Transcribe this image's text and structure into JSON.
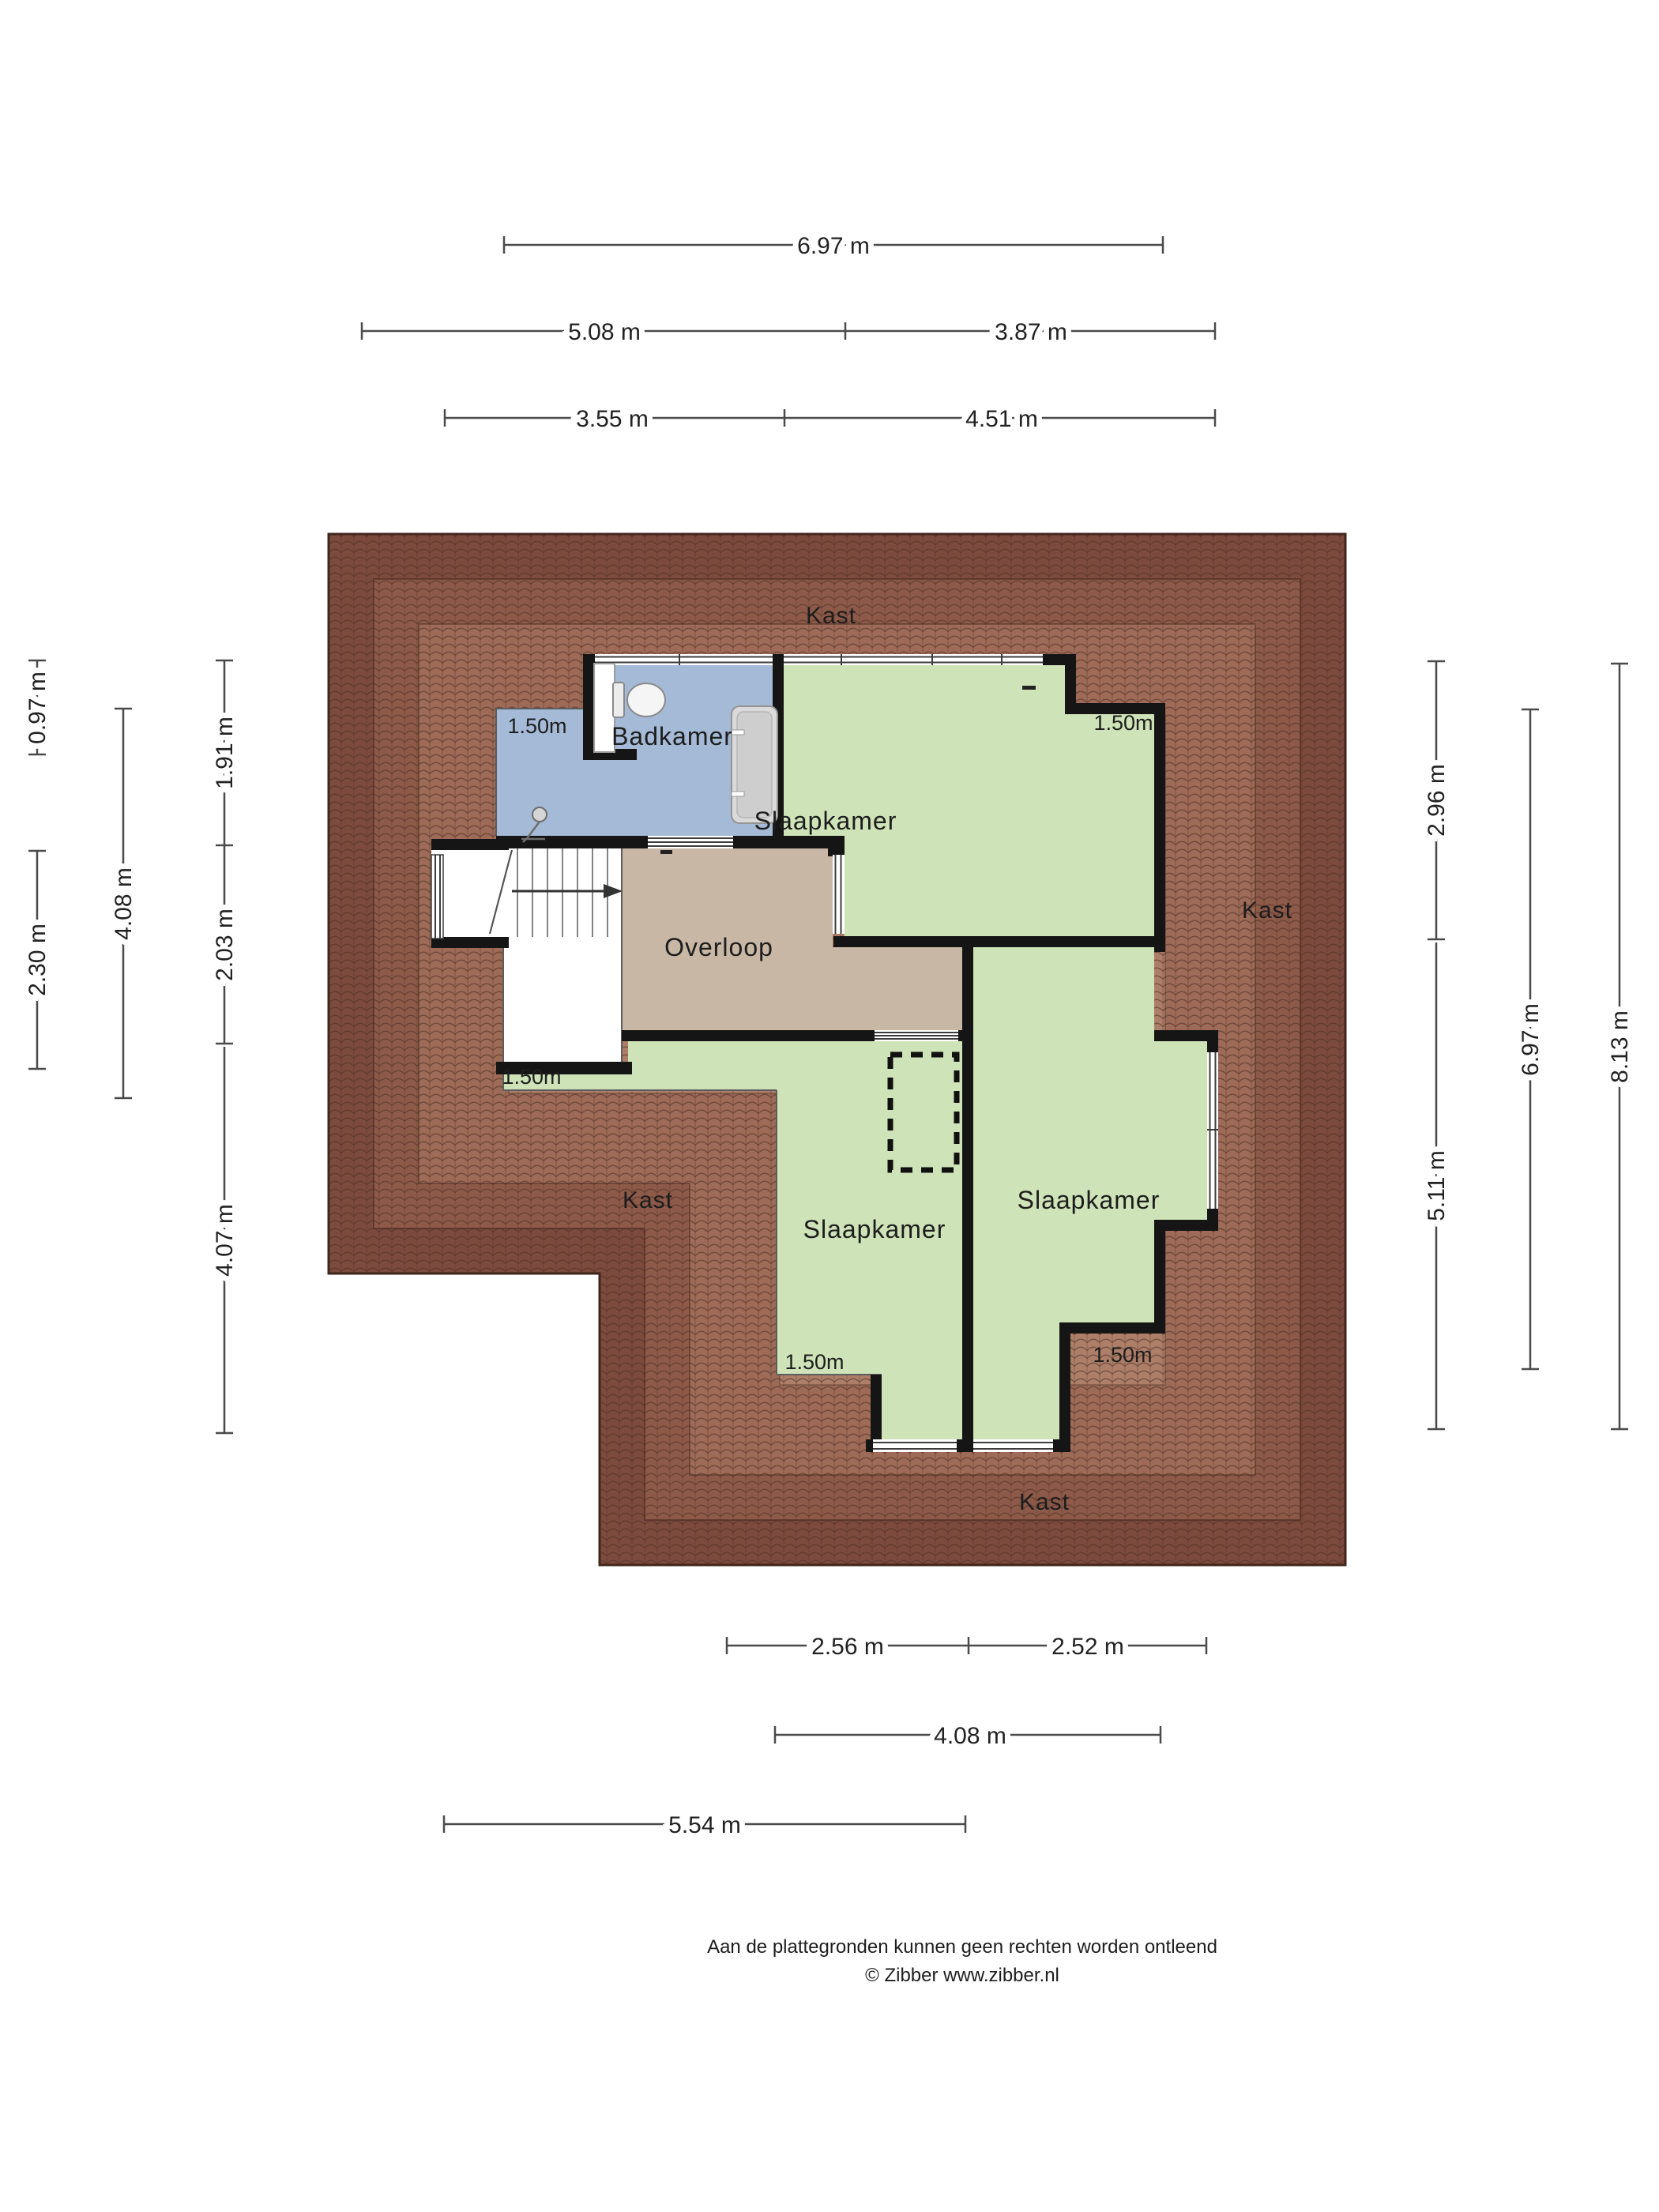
{
  "plan": {
    "rooms": [
      {
        "name": "Badkamer"
      },
      {
        "name": "Slaapkamer"
      },
      {
        "name": "Overloop"
      },
      {
        "name": "Slaapkamer"
      },
      {
        "name": "Slaapkamer"
      }
    ],
    "closets": [
      "Kast",
      "Kast",
      "Kast",
      "Kast"
    ],
    "clearance_labels": [
      "1.50m",
      "1.50m",
      "1.50m",
      "1.50m",
      "1.50m"
    ],
    "icons": [
      "toilet-icon",
      "bathtub-icon",
      "shower-icon",
      "stairs-arrow-icon"
    ]
  },
  "dimensions": {
    "top": [
      "6.97 m",
      "5.08 m",
      "3.87 m",
      "3.55 m",
      "4.51 m"
    ],
    "bottom": [
      "2.56 m",
      "2.52 m",
      "4.08 m",
      "5.54 m"
    ],
    "left": [
      "0.97 m",
      "2.30 m",
      "4.08 m",
      "1.91 m",
      "2.03 m",
      "4.07 m"
    ],
    "right": [
      "2.96 m",
      "5.11 m",
      "6.97 m",
      "8.13 m"
    ]
  },
  "footer": {
    "disclaimer": "Aan de plattegronden kunnen geen rechten worden ontleend",
    "credit": "© Zibber www.zibber.nl"
  },
  "colors": {
    "roof_outer": "#7c4b3d",
    "roof_band2": "#8d5a49",
    "roof_band3": "#9d6b57",
    "roof_inner": "#ad7f69",
    "room_green": "#cfe3b8",
    "room_blue": "#a5bad6",
    "room_tan": "#c9b7a5",
    "wall": "#151515"
  }
}
